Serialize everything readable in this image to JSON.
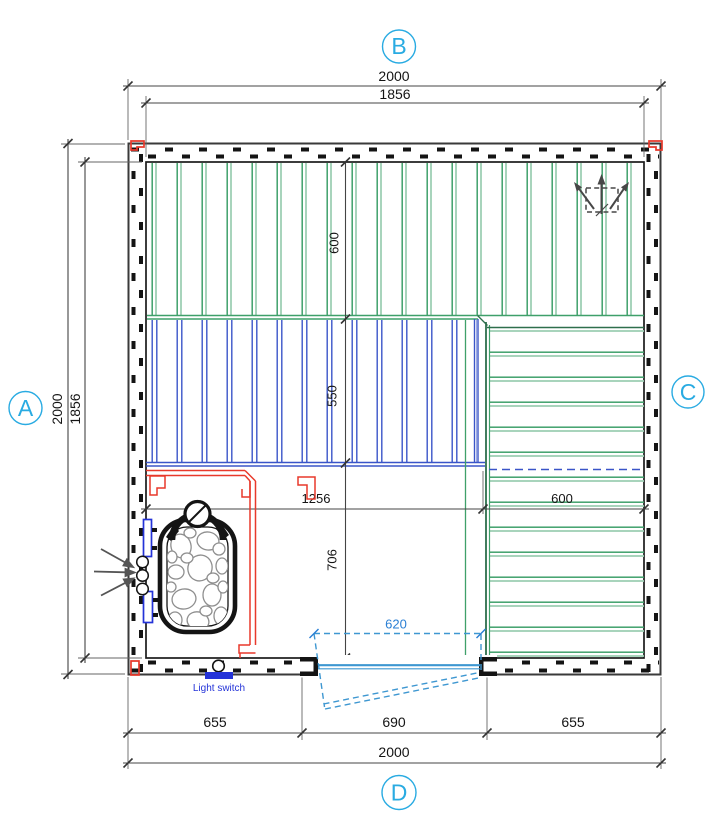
{
  "plan": {
    "type": "floor-plan",
    "grid_labels": {
      "top": "B",
      "left": "A",
      "right": "C",
      "bottom": "D"
    },
    "dims": {
      "top_outer": "2000",
      "top_inner": "1856",
      "left_outer": "2000",
      "left_inner": "1856",
      "bench_top_depth": "600",
      "bench_mid_depth": "550",
      "floor_height": "706",
      "floor_width": "1256",
      "bench_right_depth": "600",
      "door_clear": "620",
      "bottom_left": "655",
      "bottom_mid": "690",
      "bottom_right": "655",
      "bottom_total": "2000"
    },
    "annotations": {
      "light_switch": "Light switch"
    },
    "colors": {
      "accent_cyan": "#29abe2",
      "bench_green": "#3fa06a",
      "bench_green_pale": "#9fd0b4",
      "bench_blue": "#3a55c8",
      "guard_red": "#e8392b",
      "door_blue": "#3e97d1",
      "label_blue": "#2433d8",
      "line_dark": "#141414",
      "dim_gray": "#444444"
    }
  }
}
